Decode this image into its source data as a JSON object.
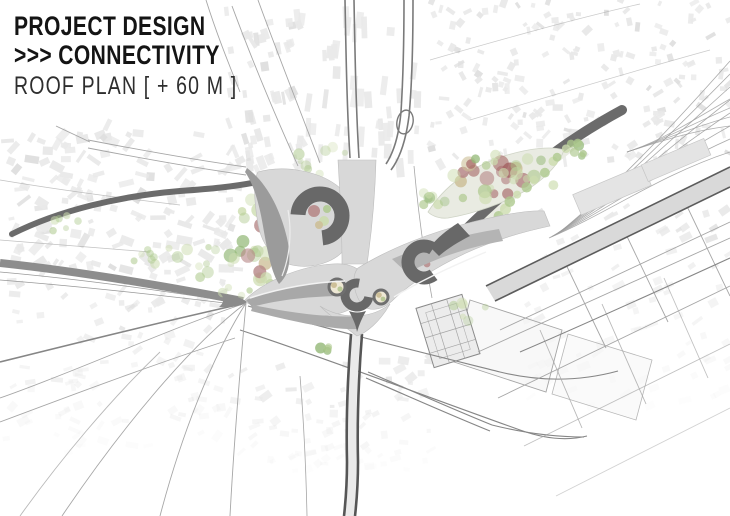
{
  "title": {
    "line1": "PROJECT DESIGN",
    "line2": ">>> CONNECTIVITY",
    "line3": "ROOF PLAN [ + 60 M ]"
  },
  "palette": {
    "paper": "#ffffff",
    "ink": "#141414",
    "subInk": "#2e2e2e",
    "fabric": "#e9e9e9",
    "fabricDark": "#dfdfdf",
    "street": "#a6a6a6",
    "streetDark": "#868686",
    "roadBand": "#8d8d8d",
    "roadDark": "#6b6b6b",
    "highway": "#565656",
    "railBand": "#d9d9d9",
    "railEdge": "#5c5c5c",
    "structureLight": "#d8d8d8",
    "structureMid": "#a2a2a2",
    "structureDark": "#686868",
    "leafBase": "#e9ebe2",
    "treeGreenLight": "#ccdcae",
    "treeGreen": "#aec98e",
    "treeGreenDark": "#93b877",
    "treeRed": "#b58585",
    "treeRedDark": "#a36363",
    "treeBeige": "#cdbf98"
  }
}
